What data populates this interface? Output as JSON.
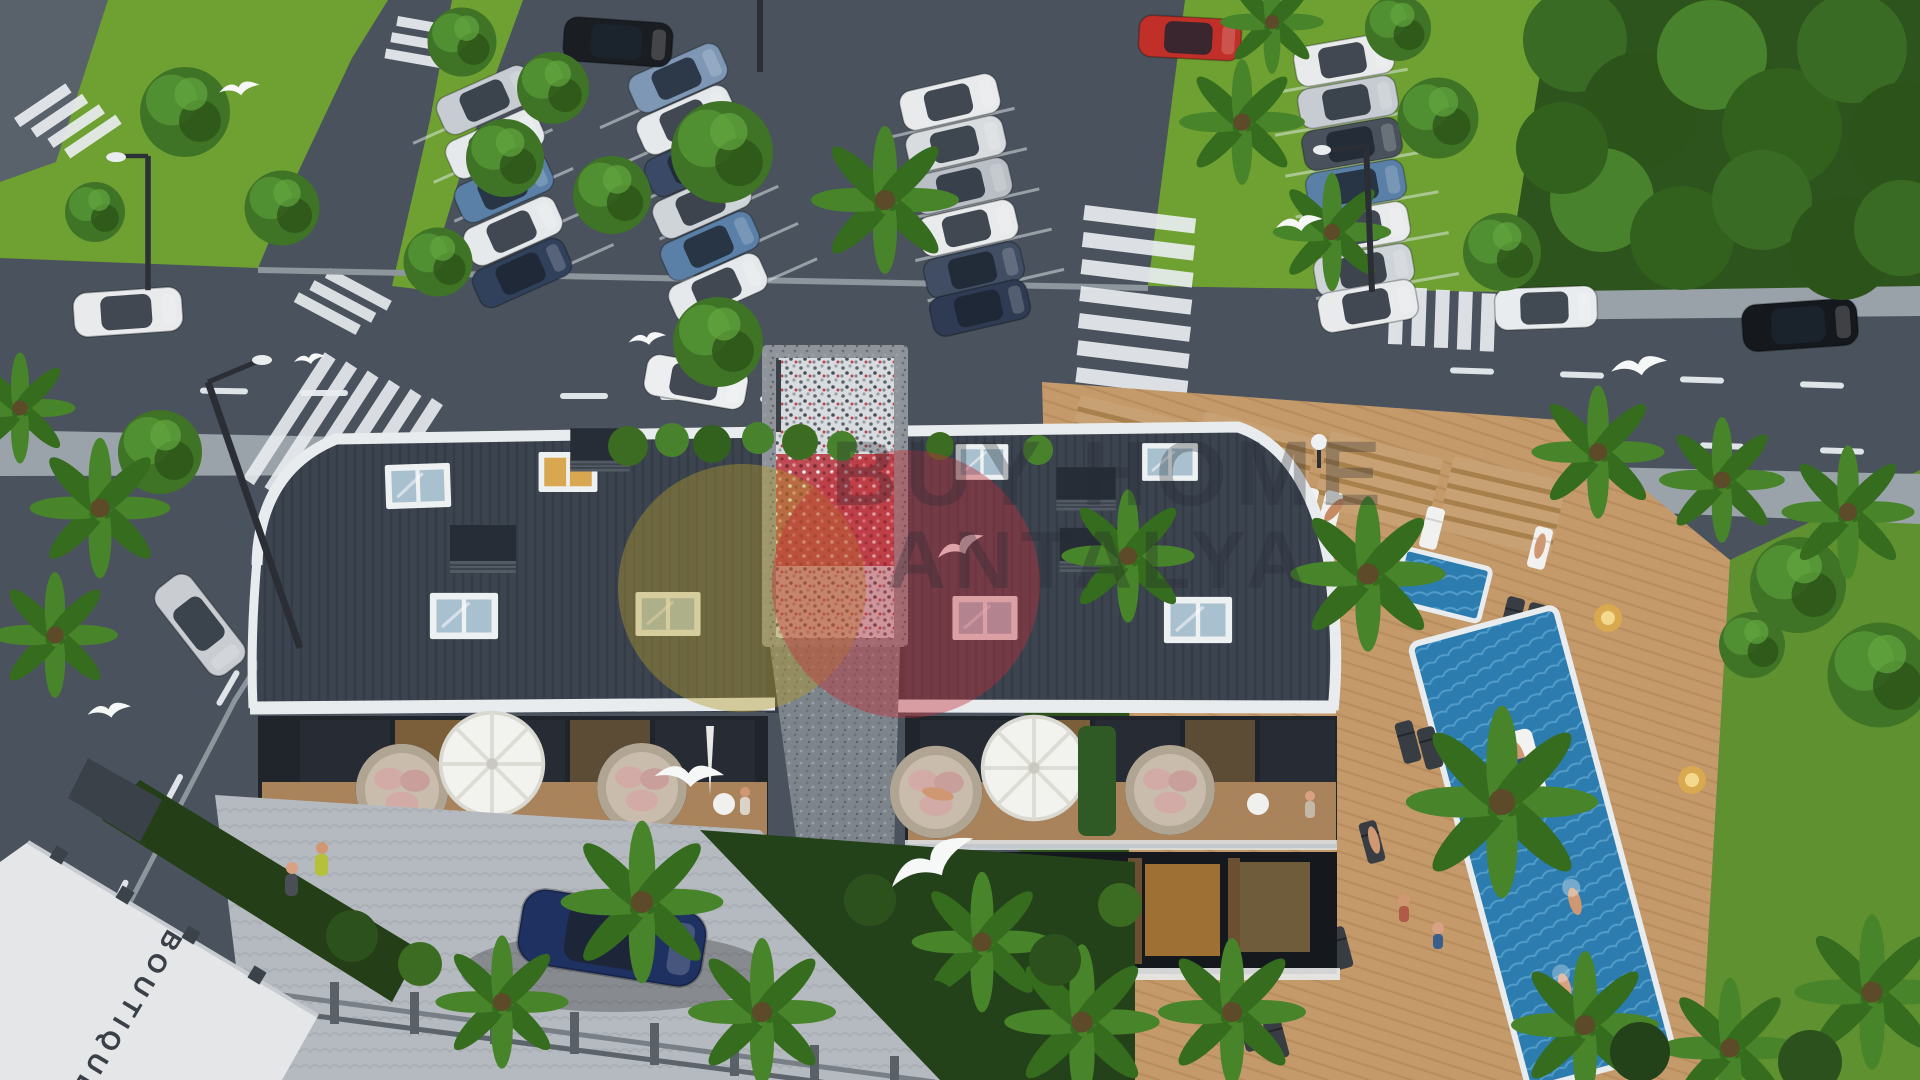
{
  "watermark": {
    "line1": "BUY HOME",
    "line2": "ANTALYA",
    "logo": {
      "gold_color": "#b49b2b",
      "red_color": "#c1303a"
    }
  },
  "signage": {
    "wall_sign": "BOUTIQUE"
  },
  "palette": {
    "asphalt": "#4a535d",
    "lawn": "#6fa132",
    "forest": "#2e541d",
    "roof": "#3c4450",
    "fascia": "#e9ecee",
    "pool_water": "#2d7cb0",
    "deck_wood": "#c59a6b",
    "cobblestone": "#b5bac0",
    "window_glow": "#e8a84e",
    "navy_car": "#1e3161"
  }
}
